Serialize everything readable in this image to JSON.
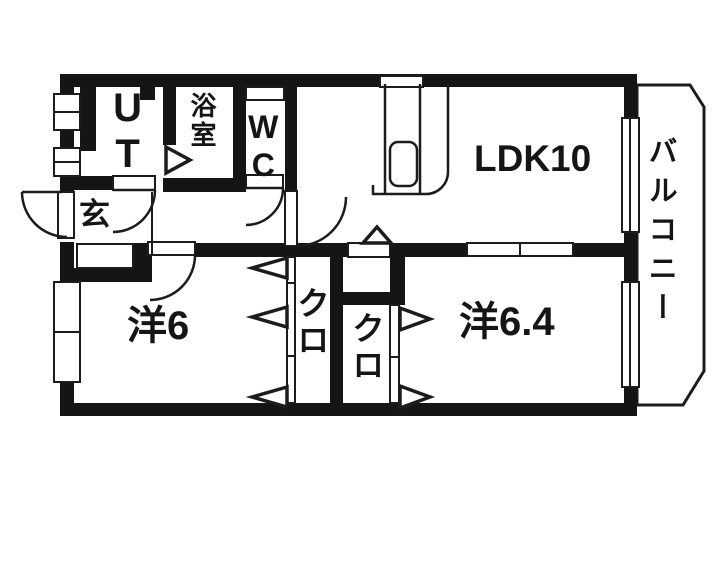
{
  "title": "2LDK apartment floor plan",
  "colors": {
    "wall": "#151515",
    "line": "#1c1c1c",
    "background": "#ffffff"
  },
  "rooms": {
    "ut": {
      "label": "UT"
    },
    "bath": {
      "label": "浴室"
    },
    "wc": {
      "label": "WC"
    },
    "genkan": {
      "label": "玄"
    },
    "ldk": {
      "label": "LDK10"
    },
    "western6": {
      "label": "洋6"
    },
    "closet_left": {
      "label": "クロ"
    },
    "closet_mid": {
      "label": "クロ"
    },
    "western64": {
      "label": "洋6.4"
    },
    "balcony": {
      "label": "バルコニー"
    }
  }
}
